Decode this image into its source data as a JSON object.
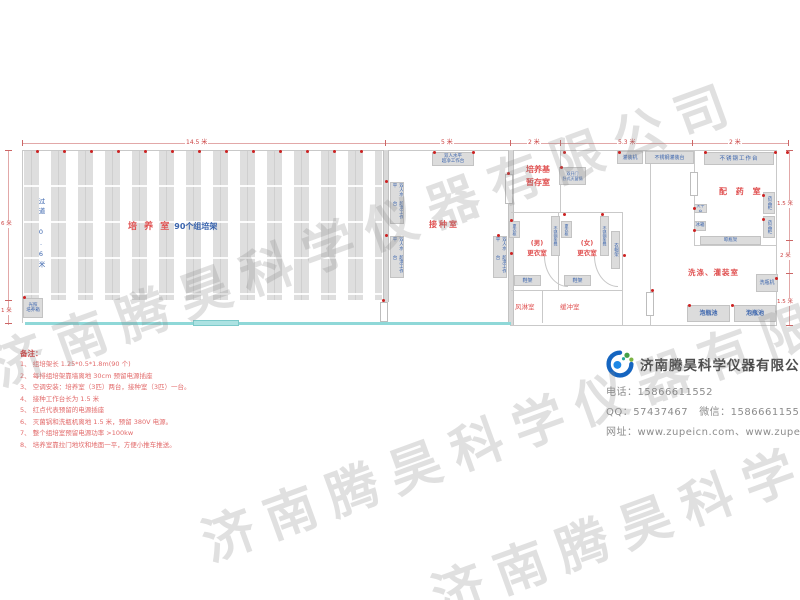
{
  "watermark_text": "济南腾昊科学仪器有限公司",
  "dimensions": {
    "top_total": "14.5 米",
    "top_inoculation": "5 米",
    "top_storage": "2 米",
    "top_middle": "5.3 米",
    "top_dispensing": "2 米",
    "left_height": "6 米",
    "left_bottom": "1 米",
    "right_top": "1.5 米",
    "right_middle": "2 米",
    "right_bottom": "1.5 米"
  },
  "cultivation_room": {
    "name": "培 养 室",
    "rack_count": "90个组培架",
    "aisle": "过道 0.6米",
    "incubator_line1": "光照",
    "incubator_line2": "培养箱"
  },
  "inoculation_room": {
    "name": "接种室",
    "bench_line1": "双人水平",
    "bench_line2": "超净工作台"
  },
  "storage_room": {
    "name_line1": "培养基",
    "name_line2": "暂存室",
    "sterilizer_line1": "双开门",
    "sterilizer_line2": "卧式灭菌锅"
  },
  "changing_rooms": {
    "men_line1": "(男)",
    "men_line2": "更衣室",
    "women_line1": "(女)",
    "women_line2": "更衣室",
    "wardrobe": "更衣柜",
    "steel_bench": "不锈钢条凳",
    "coat_rack": "衣帽架",
    "shoe_rack": "鞋架",
    "air_shower": "风淋室",
    "buffer_room": "缓冲室"
  },
  "dispensing_room": {
    "name": "配 药 室",
    "work_table": "不锈钢工作台",
    "medicine_cabinet": "药品柜",
    "balance_table": "天平台",
    "fridge": "冰箱",
    "drying_rack": "晾瓶架"
  },
  "washing_room": {
    "name": "洗涤、灌装室",
    "filling_machine": "灌装机",
    "filling_table": "不锈钢灌装台",
    "bottle_washer": "洗瓶机",
    "soak_pool": "泡瓶池"
  },
  "notes": {
    "title": "备注：",
    "items": [
      "1、 组培架长 1.25*0.5*1.8m(90 个)",
      "2、 每排组培架靠墙离地 30cm 预留电源插座",
      "3、 空调安装：培养室（3匹）两台，接种室（3匹）一台。",
      "4、 接种工作台长为 1.5 米",
      "5、 红点代表预留的电源插座",
      "6、 灭菌锅和洗瓶机离地 1.5 米，预留 380V 电源。",
      "7、 整个组培室预留电源功率 >100kw",
      "8、 培养室靠拉门地坎和地面一平，方便小推车推送。"
    ]
  },
  "company": {
    "name": "济南腾昊科学仪器有限公司",
    "phone": "电话：15866611552",
    "qq": "QQ：57437467",
    "wechat": "微信：15866611552",
    "website": "网址：www.zupeicn.com、www.zupei17.com"
  },
  "colors": {
    "accent_red": "#e05252",
    "label_blue": "#3a64ad",
    "corridor_cyan": "#8fd8d8",
    "socket_dot_red": "#cc2222"
  },
  "socket_dots": [
    [
      36,
      150
    ],
    [
      63,
      150
    ],
    [
      90,
      150
    ],
    [
      117,
      150
    ],
    [
      144,
      150
    ],
    [
      171,
      150
    ],
    [
      198,
      150
    ],
    [
      225,
      150
    ],
    [
      252,
      150
    ],
    [
      279,
      150
    ],
    [
      306,
      150
    ],
    [
      333,
      150
    ],
    [
      360,
      150
    ],
    [
      433,
      151
    ],
    [
      472,
      151
    ],
    [
      563,
      151
    ],
    [
      618,
      151
    ],
    [
      704,
      151
    ],
    [
      774,
      151
    ],
    [
      786,
      151
    ],
    [
      385,
      180
    ],
    [
      385,
      234
    ],
    [
      497,
      234
    ],
    [
      510,
      219
    ],
    [
      510,
      252
    ],
    [
      560,
      166
    ],
    [
      563,
      213
    ],
    [
      601,
      213
    ],
    [
      623,
      254
    ],
    [
      651,
      289
    ],
    [
      693,
      207
    ],
    [
      693,
      229
    ],
    [
      762,
      194
    ],
    [
      762,
      218
    ],
    [
      775,
      277
    ],
    [
      731,
      304
    ],
    [
      688,
      304
    ],
    [
      23,
      296
    ],
    [
      382,
      299
    ],
    [
      507,
      172
    ]
  ]
}
